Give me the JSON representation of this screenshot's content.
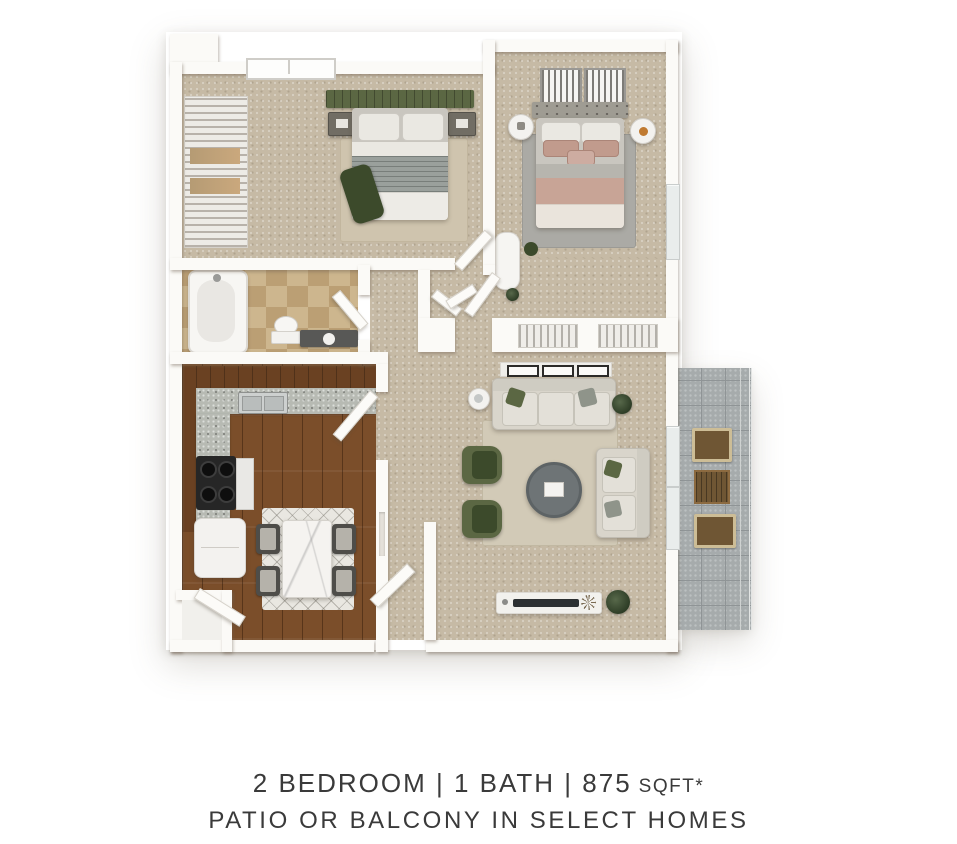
{
  "caption": {
    "line1_main": "2 BEDROOM | 1 BATH | 875",
    "line1_unit": "SQFT*",
    "line2": "PATIO OR BALCONY IN SELECT HOMES"
  },
  "colors": {
    "page-bg": "#ffffff",
    "wall-color": "#fbfaf7",
    "carpet-color": "#c6baa5",
    "wood-color": "#7b4e2a",
    "wood-trim-color": "#6a4122",
    "bath-tile-color": "#cdb68e",
    "bath-tile-dark-color": "#bb9f74",
    "patio-tile-color": "#a6abac",
    "patio-grout-color": "#8f9496",
    "patio-wood-color": "#6f5634",
    "olive-color": "#5b6743",
    "olive-dark-color": "#3c4a2b",
    "blush-color": "#c8a496",
    "blush-dark-color": "#c19b8d",
    "gray-fabric-color": "#9aa09c",
    "cream-fabric-color": "#eae8e2",
    "counter-color": "#b7bab3",
    "charcoal-color": "#2e2e2c",
    "marble-color": "#f5f3f0",
    "text-color": "#3a3a3a"
  }
}
